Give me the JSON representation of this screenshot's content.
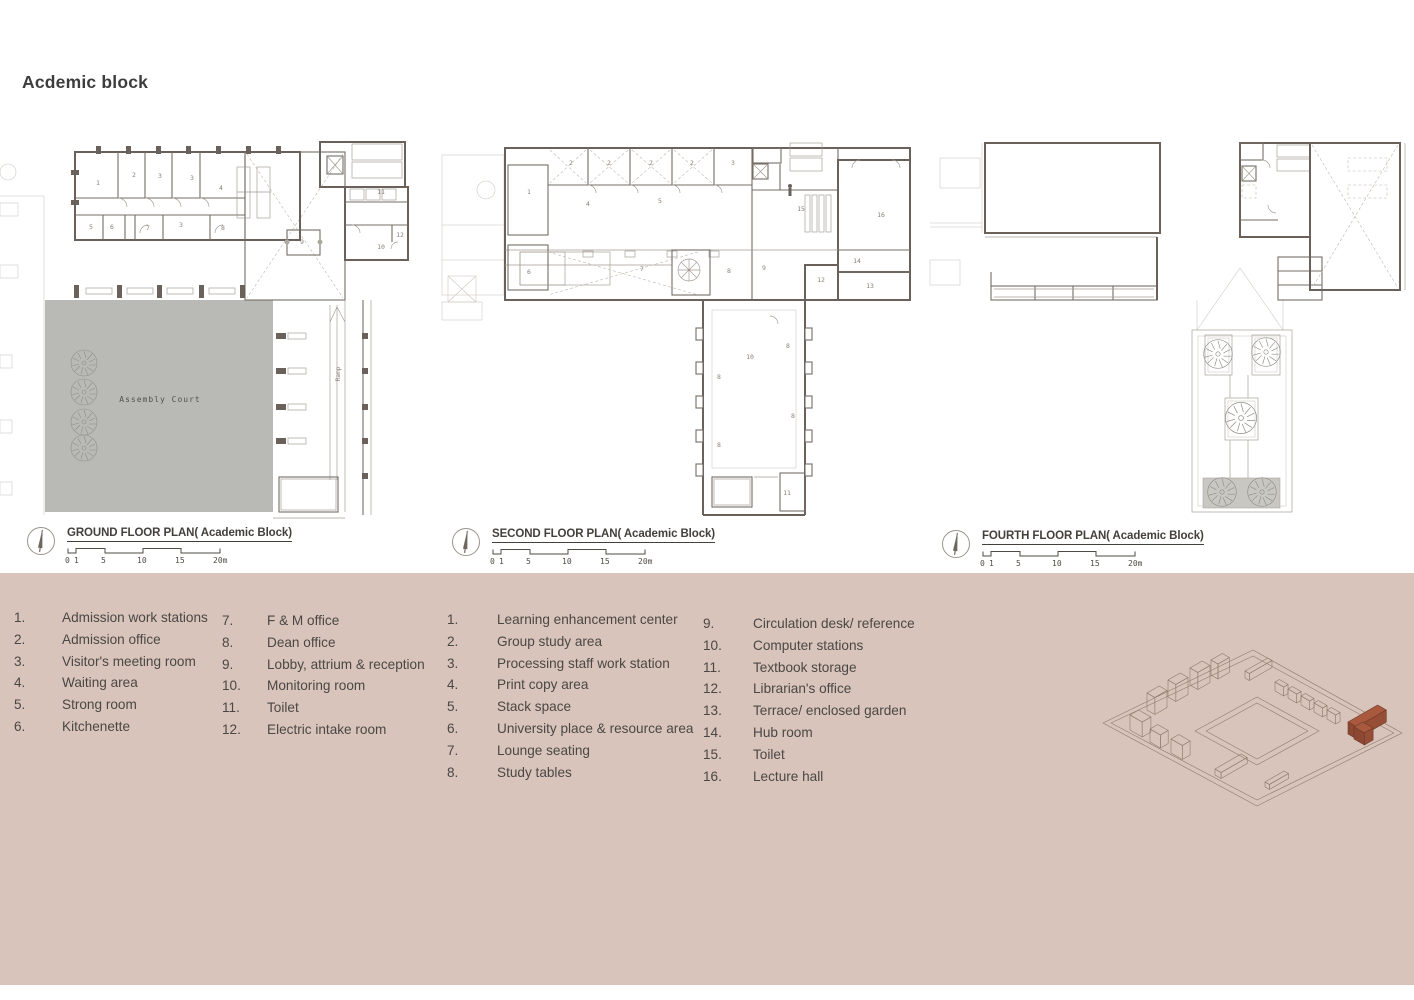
{
  "page": {
    "title": "Acdemic block",
    "panel_color": "#d9c4bb"
  },
  "plans": [
    {
      "title": "GROUND FLOOR PLAN( Academic Block)",
      "scale_ticks": [
        "0",
        "1",
        "5",
        "10",
        "15",
        "20m"
      ],
      "court_label": "Assembly Court",
      "labels": [
        {
          "x": 98,
          "y": 55,
          "t": "1"
        },
        {
          "x": 134,
          "y": 47,
          "t": "2"
        },
        {
          "x": 160,
          "y": 48,
          "t": "3"
        },
        {
          "x": 192,
          "y": 50,
          "t": "3"
        },
        {
          "x": 221,
          "y": 60,
          "t": "4"
        },
        {
          "x": 91,
          "y": 99,
          "t": "5"
        },
        {
          "x": 112,
          "y": 99,
          "t": "6"
        },
        {
          "x": 148,
          "y": 100,
          "t": "7"
        },
        {
          "x": 181,
          "y": 97,
          "t": "3"
        },
        {
          "x": 223,
          "y": 100,
          "t": "8"
        },
        {
          "x": 302,
          "y": 114,
          "t": "9"
        },
        {
          "x": 381,
          "y": 64,
          "t": "11"
        },
        {
          "x": 381,
          "y": 119,
          "t": "10"
        },
        {
          "x": 400,
          "y": 107,
          "t": "12"
        },
        {
          "x": 160,
          "y": 272,
          "t": "Assembly Court",
          "cls": "big"
        },
        {
          "x": 340,
          "y": 244,
          "t": "Ramp",
          "cls": "sm",
          "r": -90
        }
      ]
    },
    {
      "title": "SECOND FLOOR PLAN( Academic Block)",
      "scale_ticks": [
        "0",
        "1",
        "5",
        "10",
        "15",
        "20m"
      ],
      "labels": [
        {
          "x": 89,
          "y": 64,
          "t": "1"
        },
        {
          "x": 131,
          "y": 35,
          "t": "2"
        },
        {
          "x": 169,
          "y": 35,
          "t": "2"
        },
        {
          "x": 211,
          "y": 35,
          "t": "2"
        },
        {
          "x": 252,
          "y": 35,
          "t": "2"
        },
        {
          "x": 293,
          "y": 35,
          "t": "3"
        },
        {
          "x": 148,
          "y": 76,
          "t": "4"
        },
        {
          "x": 220,
          "y": 73,
          "t": "5"
        },
        {
          "x": 89,
          "y": 144,
          "t": "6"
        },
        {
          "x": 202,
          "y": 141,
          "t": "7"
        },
        {
          "x": 289,
          "y": 143,
          "t": "8"
        },
        {
          "x": 324,
          "y": 140,
          "t": "9"
        },
        {
          "x": 361,
          "y": 81,
          "t": "15"
        },
        {
          "x": 441,
          "y": 87,
          "t": "16"
        },
        {
          "x": 417,
          "y": 133,
          "t": "14"
        },
        {
          "x": 381,
          "y": 152,
          "t": "12"
        },
        {
          "x": 430,
          "y": 158,
          "t": "13"
        },
        {
          "x": 310,
          "y": 229,
          "t": "10"
        },
        {
          "x": 348,
          "y": 218,
          "t": "8"
        },
        {
          "x": 279,
          "y": 249,
          "t": "8"
        },
        {
          "x": 353,
          "y": 288,
          "t": "8"
        },
        {
          "x": 279,
          "y": 317,
          "t": "8"
        },
        {
          "x": 347,
          "y": 365,
          "t": "11"
        }
      ]
    },
    {
      "title": "FOURTH FLOOR PLAN( Academic Block)",
      "scale_ticks": [
        "0",
        "1",
        "5",
        "10",
        "15",
        "20m"
      ],
      "labels": []
    }
  ],
  "legend_columns": [
    {
      "items": [
        {
          "n": "1.",
          "t": "Admission work stations"
        },
        {
          "n": "2.",
          "t": "Admission office"
        },
        {
          "n": "3.",
          "t": "Visitor's meeting room"
        },
        {
          "n": "4.",
          "t": "Waiting area"
        },
        {
          "n": "5.",
          "t": "Strong room"
        },
        {
          "n": "6.",
          "t": "Kitchenette"
        }
      ]
    },
    {
      "items": [
        {
          "n": "7.",
          "t": "F & M office"
        },
        {
          "n": "8.",
          "t": "Dean office"
        },
        {
          "n": "9.",
          "t": "Lobby, attrium & reception"
        },
        {
          "n": "10.",
          "t": "Monitoring room"
        },
        {
          "n": "11.",
          "t": "Toilet"
        },
        {
          "n": "12.",
          "t": "Electric intake room"
        }
      ]
    },
    {
      "items": [
        {
          "n": "1.",
          "t": "Learning enhancement center"
        },
        {
          "n": "2.",
          "t": "Group study area"
        },
        {
          "n": "3.",
          "t": "Processing staff work station"
        },
        {
          "n": "4.",
          "t": "Print copy area"
        },
        {
          "n": "5.",
          "t": "Stack space"
        },
        {
          "n": "6.",
          "t": "University place & resource area"
        },
        {
          "n": "7.",
          "t": "Lounge seating"
        },
        {
          "n": "8.",
          "t": "Study tables"
        }
      ]
    },
    {
      "items": [
        {
          "n": "9.",
          "t": "Circulation desk/ reference"
        },
        {
          "n": "10.",
          "t": "Computer stations"
        },
        {
          "n": "11.",
          "t": "Textbook storage"
        },
        {
          "n": "12.",
          "t": "Librarian's office"
        },
        {
          "n": "13.",
          "t": "Terrace/ enclosed garden"
        },
        {
          "n": "14.",
          "t": "Hub room"
        },
        {
          "n": "15.",
          "t": "Toilet"
        },
        {
          "n": "16.",
          "t": "Lecture hall"
        }
      ]
    }
  ],
  "site_diagram": {
    "highlight_color": "#a9593d",
    "highlight_name": "academic-block"
  }
}
